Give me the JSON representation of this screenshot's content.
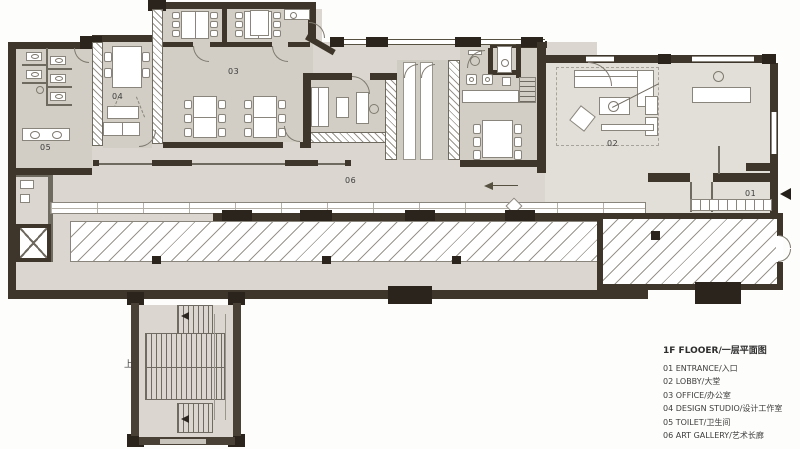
{
  "plan": {
    "room_labels": {
      "entrance": "01",
      "lobby": "02",
      "office": "03",
      "studio": "04",
      "toilet": "05",
      "gallery": "06"
    },
    "stair_up": "上"
  },
  "legend": {
    "title": "1F FLOOER/一层平面图",
    "items": [
      "01 ENTRANCE/入口",
      "02 LOBBY/大堂",
      "03 OFFICE/办公室",
      "04 DESIGN STUDIO/设计工作室",
      "05 TOILET/卫生间",
      "06 ART GALLERY/艺术长廊"
    ]
  },
  "colors": {
    "wall": "#3e362a",
    "column": "#2a241d",
    "floor": "#dbd7d0",
    "room_fill": "#d2cec5",
    "lobby_fill": "#e2dfd8",
    "furniture_stroke": "#8a857c",
    "hatch_line": "#9a958c",
    "background": "#fdfdfb",
    "text": "#3c3c3c"
  }
}
